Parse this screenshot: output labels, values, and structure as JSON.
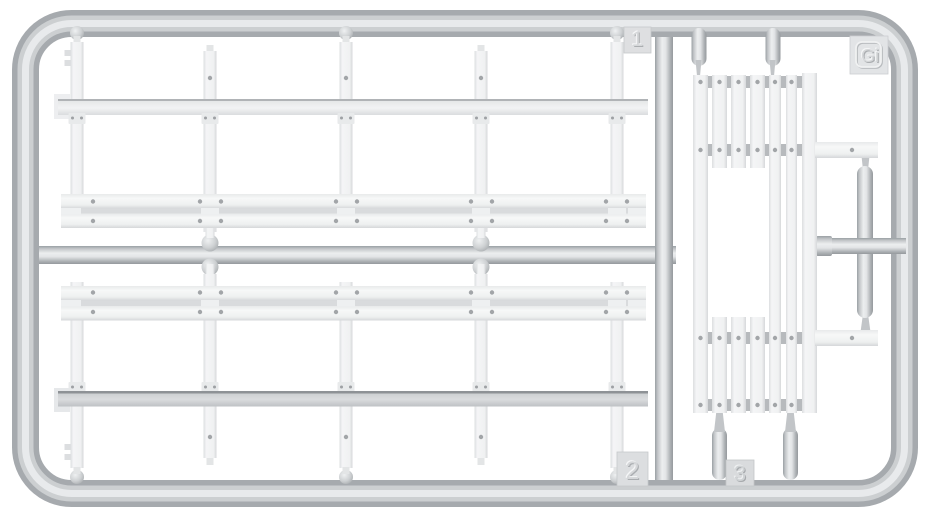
{
  "scene": {
    "type": "product-photo",
    "subject": "Light gray injection-molded plastic model sprue with stake-and-plank rail parts",
    "background_color": "#ffffff",
    "runner_color": "#c6c9cc",
    "part_color": "#f2f3f4"
  },
  "sprue": {
    "tabs": [
      {
        "id": "tab-1",
        "label": "1"
      },
      {
        "id": "tab-2",
        "label": "2"
      },
      {
        "id": "tab-3",
        "label": "3"
      },
      {
        "id": "tab-letter",
        "label": "Gi"
      }
    ]
  }
}
